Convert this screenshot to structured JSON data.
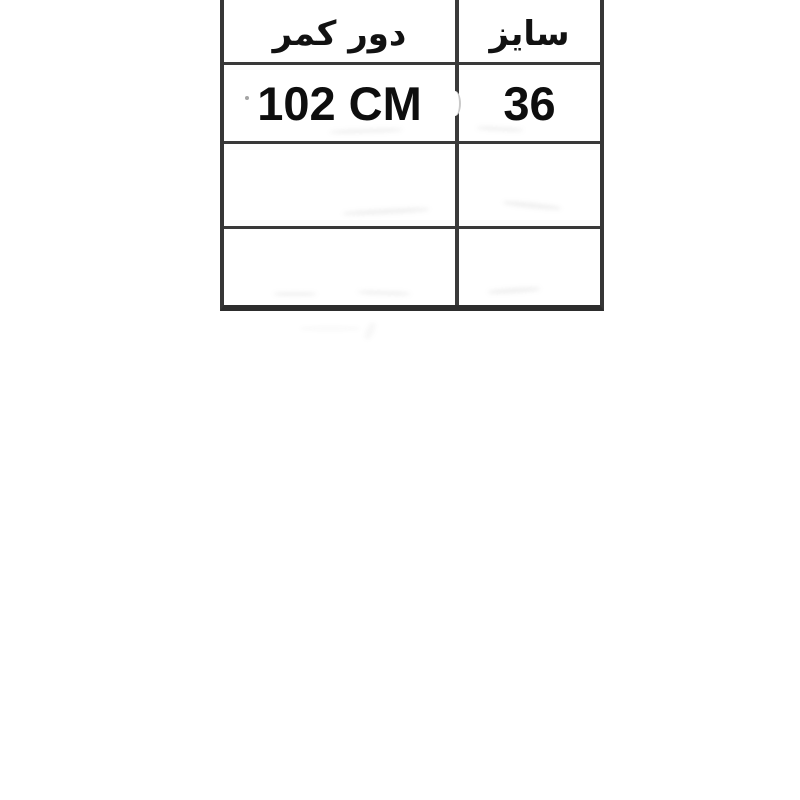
{
  "page": {
    "background_color": "#ffffff",
    "language": "fa",
    "direction": "rtl"
  },
  "size_table": {
    "border_color": "#363636",
    "text_color": "#0e0e0e",
    "columns_rtl_order": [
      "سایز",
      "دور کمر"
    ],
    "header": {
      "size_label": "سایز",
      "waist_label": "دور کمر"
    },
    "rows": [
      {
        "size": "36",
        "waist": "102 CM"
      },
      {
        "size": "",
        "waist": ""
      },
      {
        "size": "",
        "waist": ""
      }
    ]
  }
}
